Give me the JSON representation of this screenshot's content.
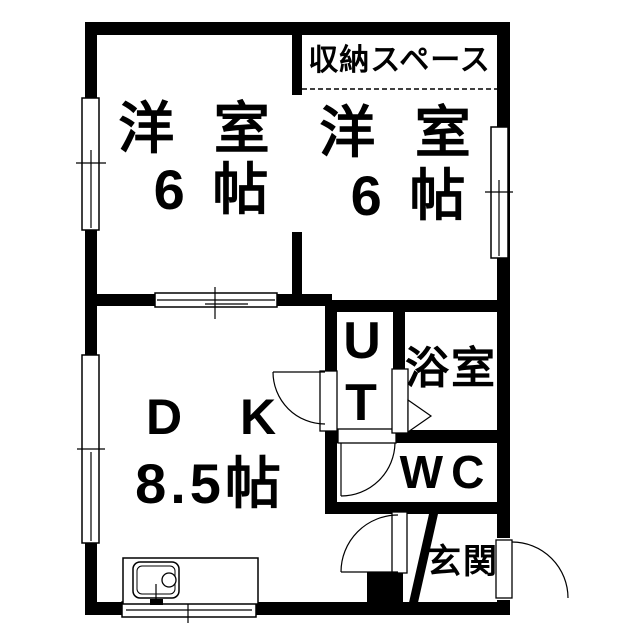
{
  "rooms": {
    "storage": {
      "label": "収納スペース"
    },
    "western_room_left": {
      "name": "洋 室",
      "size": "6 帖"
    },
    "western_room_right": {
      "name": "洋 室",
      "size": "6 帖"
    },
    "dining_kitchen": {
      "name": "D K",
      "size": "8.5帖"
    },
    "utility": {
      "line1": "U",
      "line2": "T"
    },
    "bathroom": {
      "label": "浴室"
    },
    "toilet": {
      "label": "WC"
    },
    "entrance": {
      "label": "玄関"
    }
  },
  "colors": {
    "walls": "#000000",
    "background": "#ffffff",
    "lines": "#000000"
  }
}
